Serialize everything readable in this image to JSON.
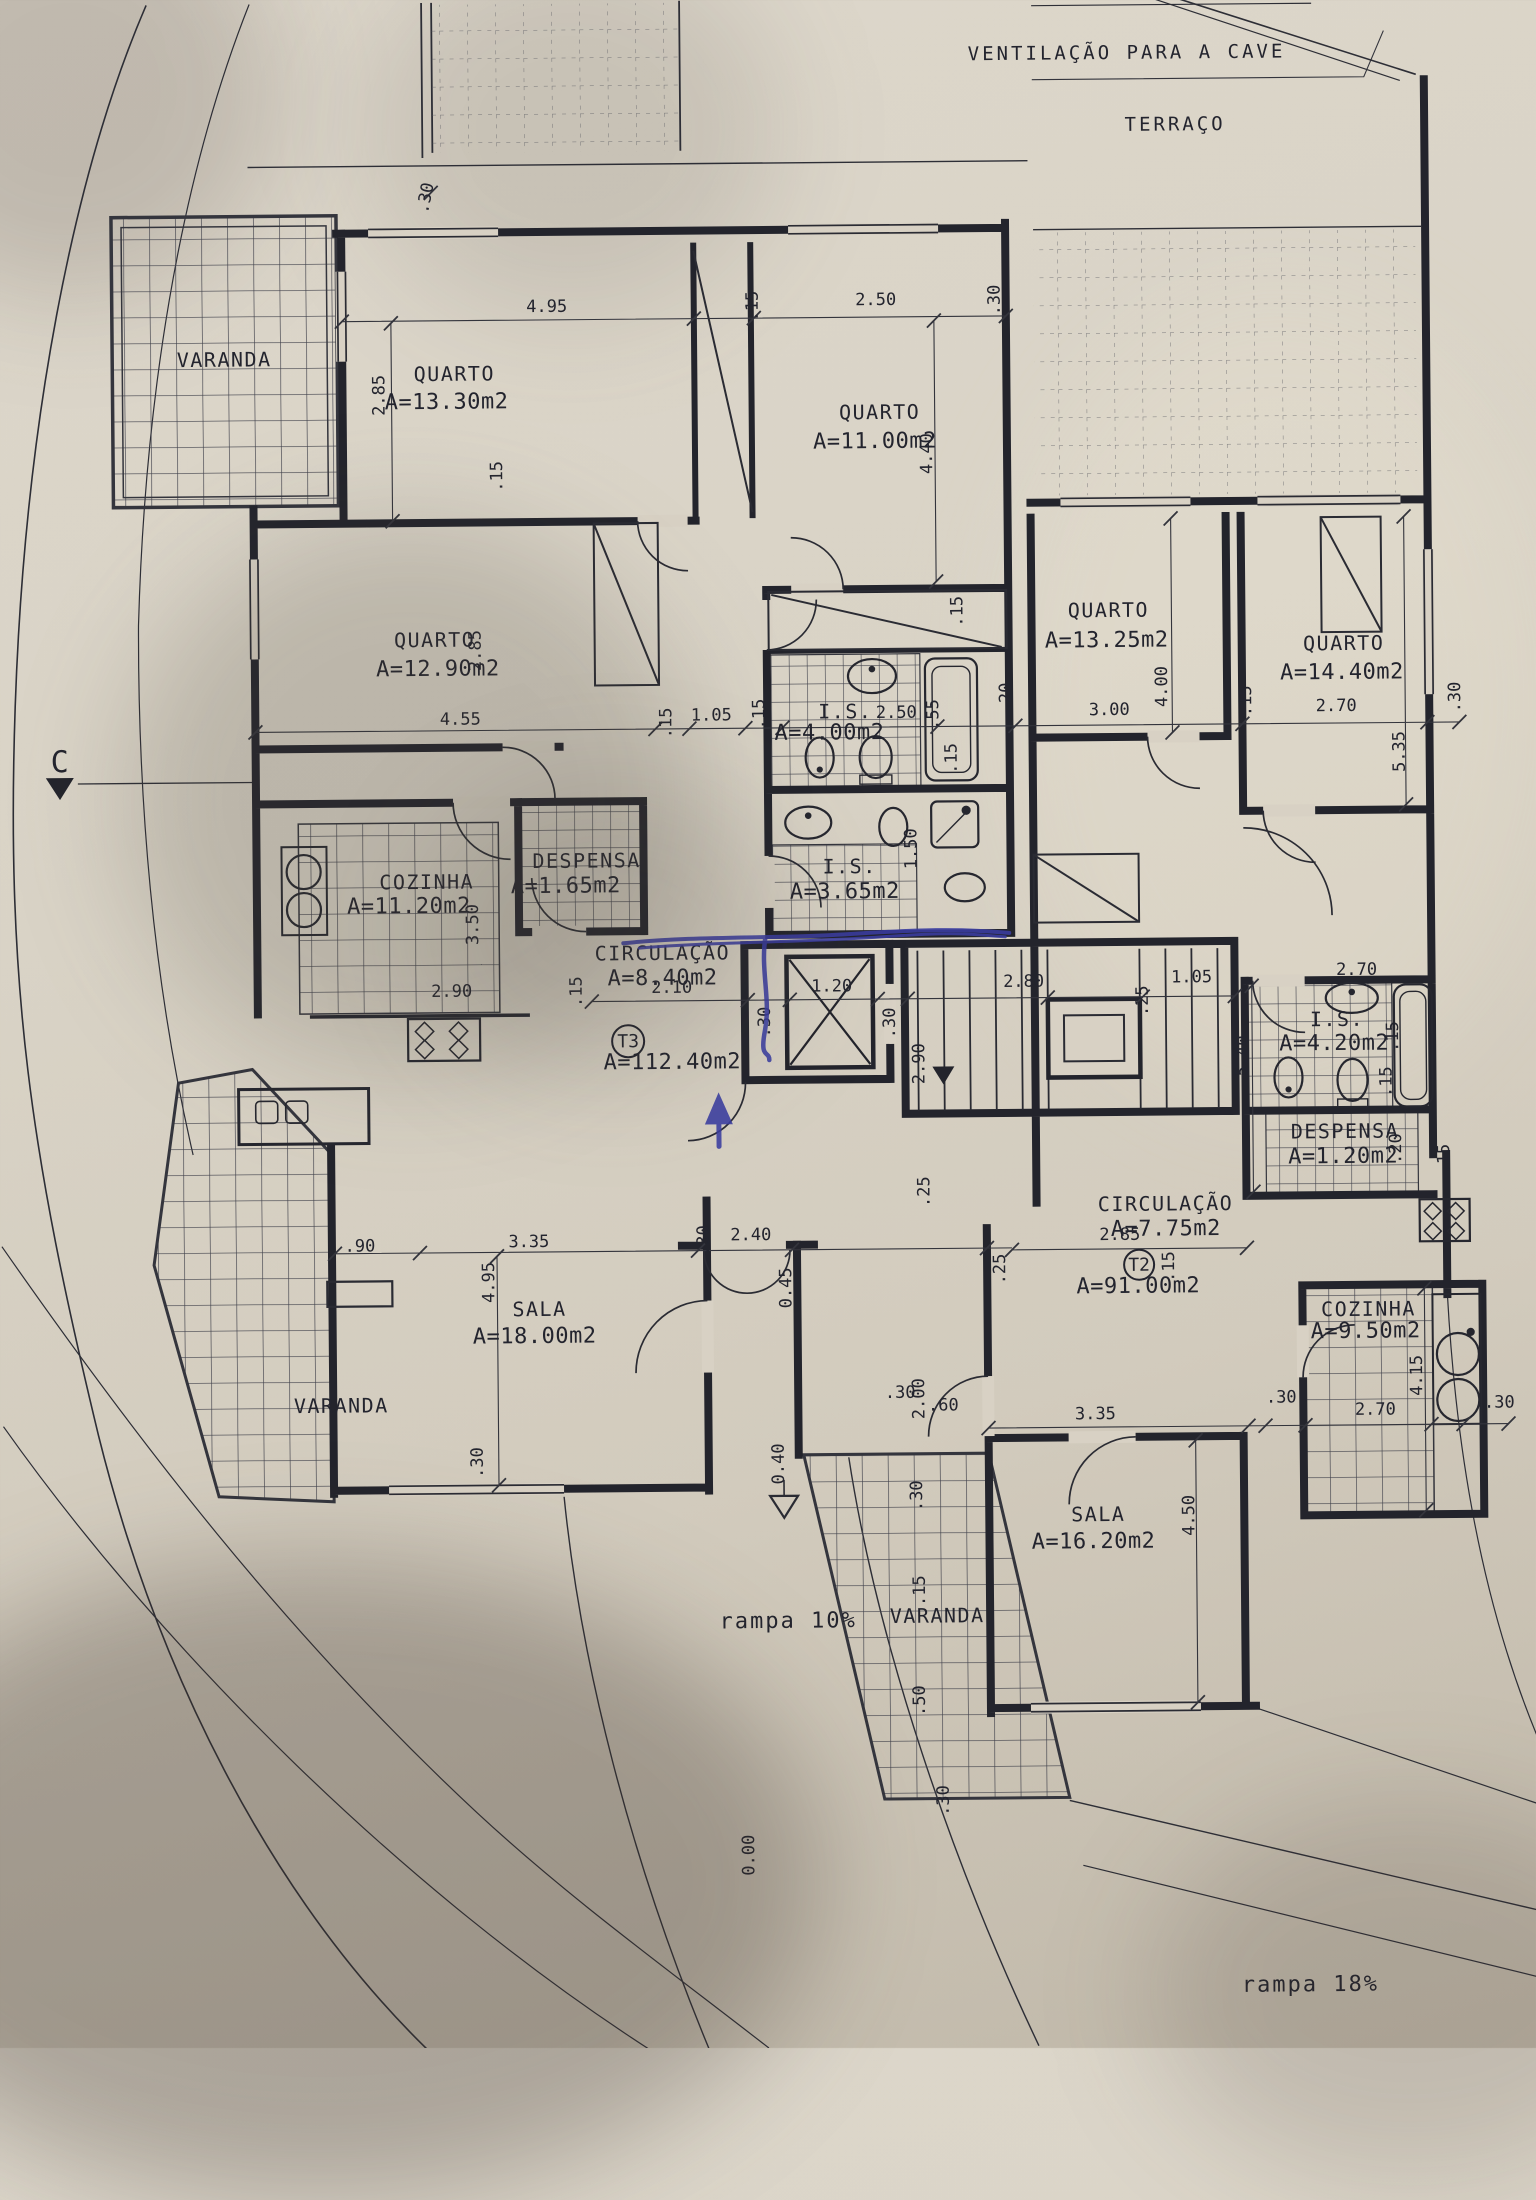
{
  "plan": {
    "site": {
      "ventilation_note": "VENTILAÇÃO PARA A CAVE",
      "terrace_label": "TERRAÇO",
      "section_marker": "C",
      "ramp_entry_label": "rampa 10%",
      "ramp_garage_label": "rampa 18%",
      "level_zero": "0.00",
      "level_entrance": "0.40"
    },
    "t3": {
      "unit_tag": "T3",
      "unit_area": "A=112.40m2",
      "varanda_label": "VARANDA",
      "varanda_sala_label": "VARANDA",
      "quarto1": {
        "label": "QUARTO",
        "area": "A=13.30m2"
      },
      "quarto2": {
        "label": "QUARTO",
        "area": "A=11.00m2"
      },
      "quarto3": {
        "label": "QUARTO",
        "area": "A=12.90m2"
      },
      "cozinha": {
        "label": "COZINHA",
        "area": "A=11.20m2"
      },
      "despensa": {
        "label": "DESPENSA",
        "area": "A=1.65m2"
      },
      "is1": {
        "label": "I.S.",
        "area": "A=4.00m2"
      },
      "is2": {
        "label": "I.S.",
        "area": "A=3.65m2"
      },
      "circulacao": {
        "label": "CIRCULAÇÃO",
        "area": "A=8.40m2"
      },
      "sala": {
        "label": "SALA",
        "area": "A=18.00m2"
      }
    },
    "t2": {
      "unit_tag": "T2",
      "unit_area": "A=91.00m2",
      "varanda_label": "VARANDA",
      "quarto1": {
        "label": "QUARTO",
        "area": "A=13.25m2"
      },
      "quarto2": {
        "label": "QUARTO",
        "area": "A=14.40m2"
      },
      "is1": {
        "label": "I.S.",
        "area": "A=4.20m2"
      },
      "despensa": {
        "label": "DESPENSA",
        "area": "A=1.20m2"
      },
      "circulacao": {
        "label": "CIRCULAÇÃO",
        "area": "A=7.75m2"
      },
      "cozinha": {
        "label": "COZINHA",
        "area": "A=9.50m2"
      },
      "sala": {
        "label": "SALA",
        "area": "A=16.20m2"
      }
    },
    "dims": {
      "top_wall_30": ".30",
      "q1_w_495": "4.95",
      "q1_h_285": "2.85",
      "q1_r_15": ".15",
      "q12_gap_15": ".15",
      "q2_w_250": "2.50",
      "q2_r_30": ".30",
      "q2_h_440": "4.40",
      "q3_h_285": "2.85",
      "q3_w_455": "4.55",
      "hall_15a": ".15",
      "hall_105": "1.05",
      "hall_15b": ".15",
      "is1_w_250": "2.50",
      "is1_55": ".55",
      "is1_15": ".15",
      "is2_h_150": "1.50",
      "t3bath_wall_15": ".15",
      "t2q1_l_20": ".20",
      "t2q1_w_300": "3.00",
      "t2q1_h_400": "4.00",
      "t2q_gap_15": ".15",
      "t2q2_w_270": "2.70",
      "t2q2_r_30": ".30",
      "t2q2_h_535": "5.35",
      "coz_h_350": "3.50",
      "coz_w_290": "2.90",
      "coz_r_15": ".15",
      "circ_w_210": "2.10",
      "elev_w_120": "1.20",
      "elev_l_30": ".30",
      "elev_r_30": ".30",
      "stair_h_290": "2.90",
      "stair_b_25": ".25",
      "t2hall_280": "2.80",
      "t2hall_25": ".25",
      "t2hall_105": "1.05",
      "t2hall_h_540": "5.40",
      "t2is_w_270": "2.70",
      "t2is_r_15": ".15",
      "t2is_b_15": ".15",
      "t2desp_20": ".20",
      "t2desp_r_15": ".15",
      "t2circ_w_285": "2.85",
      "t2circ_15": ".15",
      "t2circ_l_25": ".25",
      "sala3_90": ".90",
      "sala3_w_335": "3.35",
      "sala3_h_495": "4.95",
      "sala3_b_30": ".30",
      "entry_30": ".30",
      "entry_240": "2.40",
      "entry_045": "0.45",
      "porch_30": ".30",
      "porch_200": "2.00",
      "porch_60": ".60",
      "porch_30b": ".30",
      "sala2_w_335": "3.35",
      "sala2_h_450": "4.50",
      "coz2_l_30": ".30",
      "coz2_w_270": "2.70",
      "coz2_h_415": "4.15",
      "coz2_r_30": ".30",
      "var2_15": ".15",
      "var2_50": ".50",
      "var2_30": ".30"
    },
    "pen_color": "#3a3da1"
  }
}
